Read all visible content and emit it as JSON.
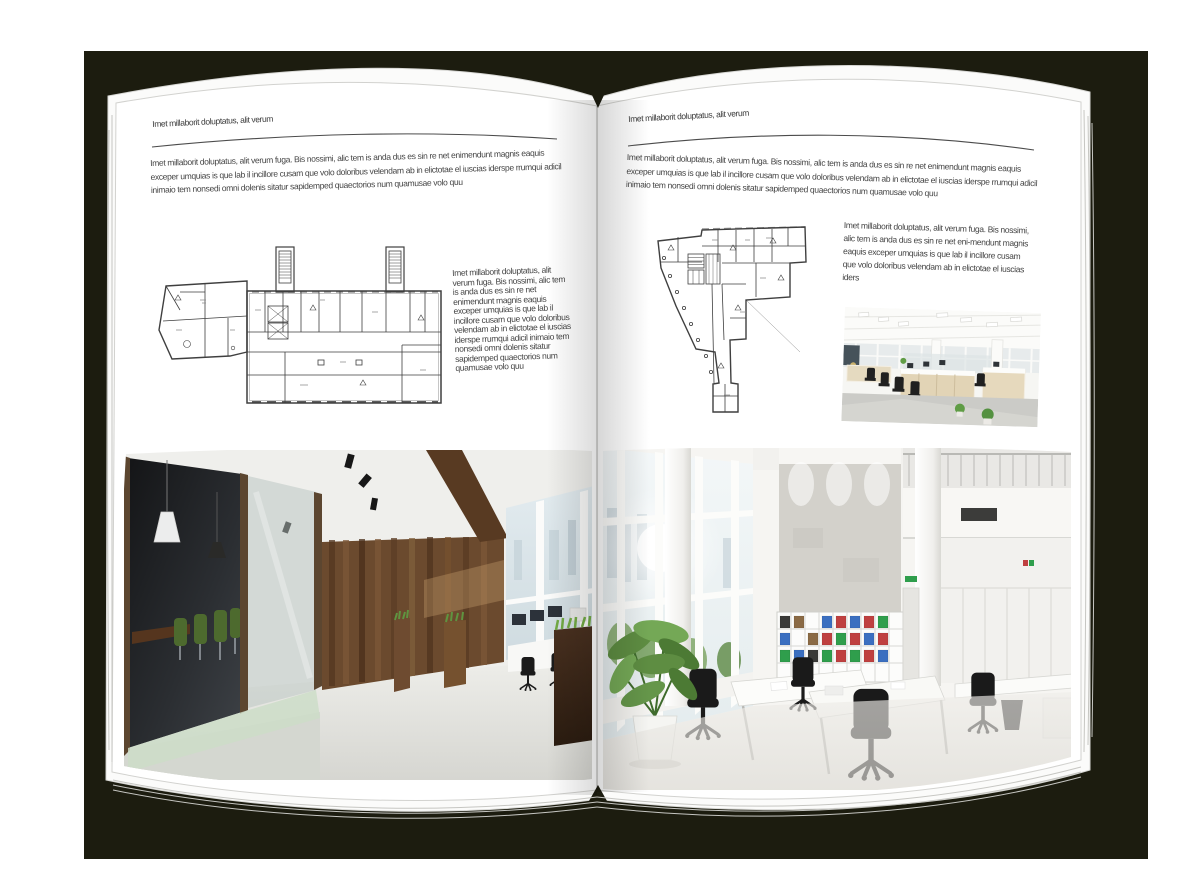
{
  "booklet": {
    "left_page": {
      "header": "Imet millaborit doluptatus, alit verum",
      "intro": "Imet millaborit doluptatus, alit verum fuga. Bis nossimi, alic tem is anda dus es sin re net enimendunt magnis eaquis exceper umquias is que lab il incillore cusam que volo doloribus velendam ab in elictotae el iuscias iderspe rrumqui adicil inimaio tem nonsedi omni dolenis sitatur sapidemped quaectorios num quamusae volo quu",
      "side_text": "Imet millaborit doluptatus, alit verum fuga. Bis nossimi, alic tem is anda dus es sin re net enimendunt magnis eaquis exceper umquias is que lab il incillore cusam que volo doloribus velendam ab in elictotae el iuscias iderspe rrumqui adicil inimaio tem nonsedi omni dolenis sitatur sapidemped quaectorios num quamusae volo quu",
      "floorplan": "wide-slab-building-floor-plan",
      "photo": "dark-wood-glass-meeting-room-office"
    },
    "right_page": {
      "header": "Imet millaborit doluptatus, alit verum",
      "intro": "Imet millaborit doluptatus, alit verum fuga. Bis nossimi, alic tem is anda dus es sin re net enimendunt magnis eaquis exceper umquias is que lab il incillore cusam que volo doloribus velendam ab in elictotae el iuscias iderspe rrumqui adicil inimaio tem nonsedi omni dolenis sitatur sapidemped quaectorios num quamusae volo quu",
      "side_text": "Imet millaborit doluptatus, alit verum fuga. Bis nossimi, alic tem is anda dus es sin re net eni-mendunt magnis eaquis exceper umquias is que lab il incillore cusam que volo doloribus velendam ab in elictotae el iuscias iders",
      "floorplan": "irregular-corner-building-floor-plan",
      "photo_small": "open-plan-office-light-wood-desks",
      "photo_large": "white-double-height-office-atrium"
    },
    "colors": {
      "backdrop": "#1c1c0f",
      "page": "#ffffff",
      "text": "#3e3e3e",
      "plan_line": "#3f3f3f",
      "wood": "#6b4a2e",
      "chair_green": "#4d6a2e",
      "plant_green": "#5f9c45",
      "binder_blue": "#3b6fc0",
      "binder_red": "#bf4040",
      "binder_green": "#2f9e4c"
    }
  }
}
